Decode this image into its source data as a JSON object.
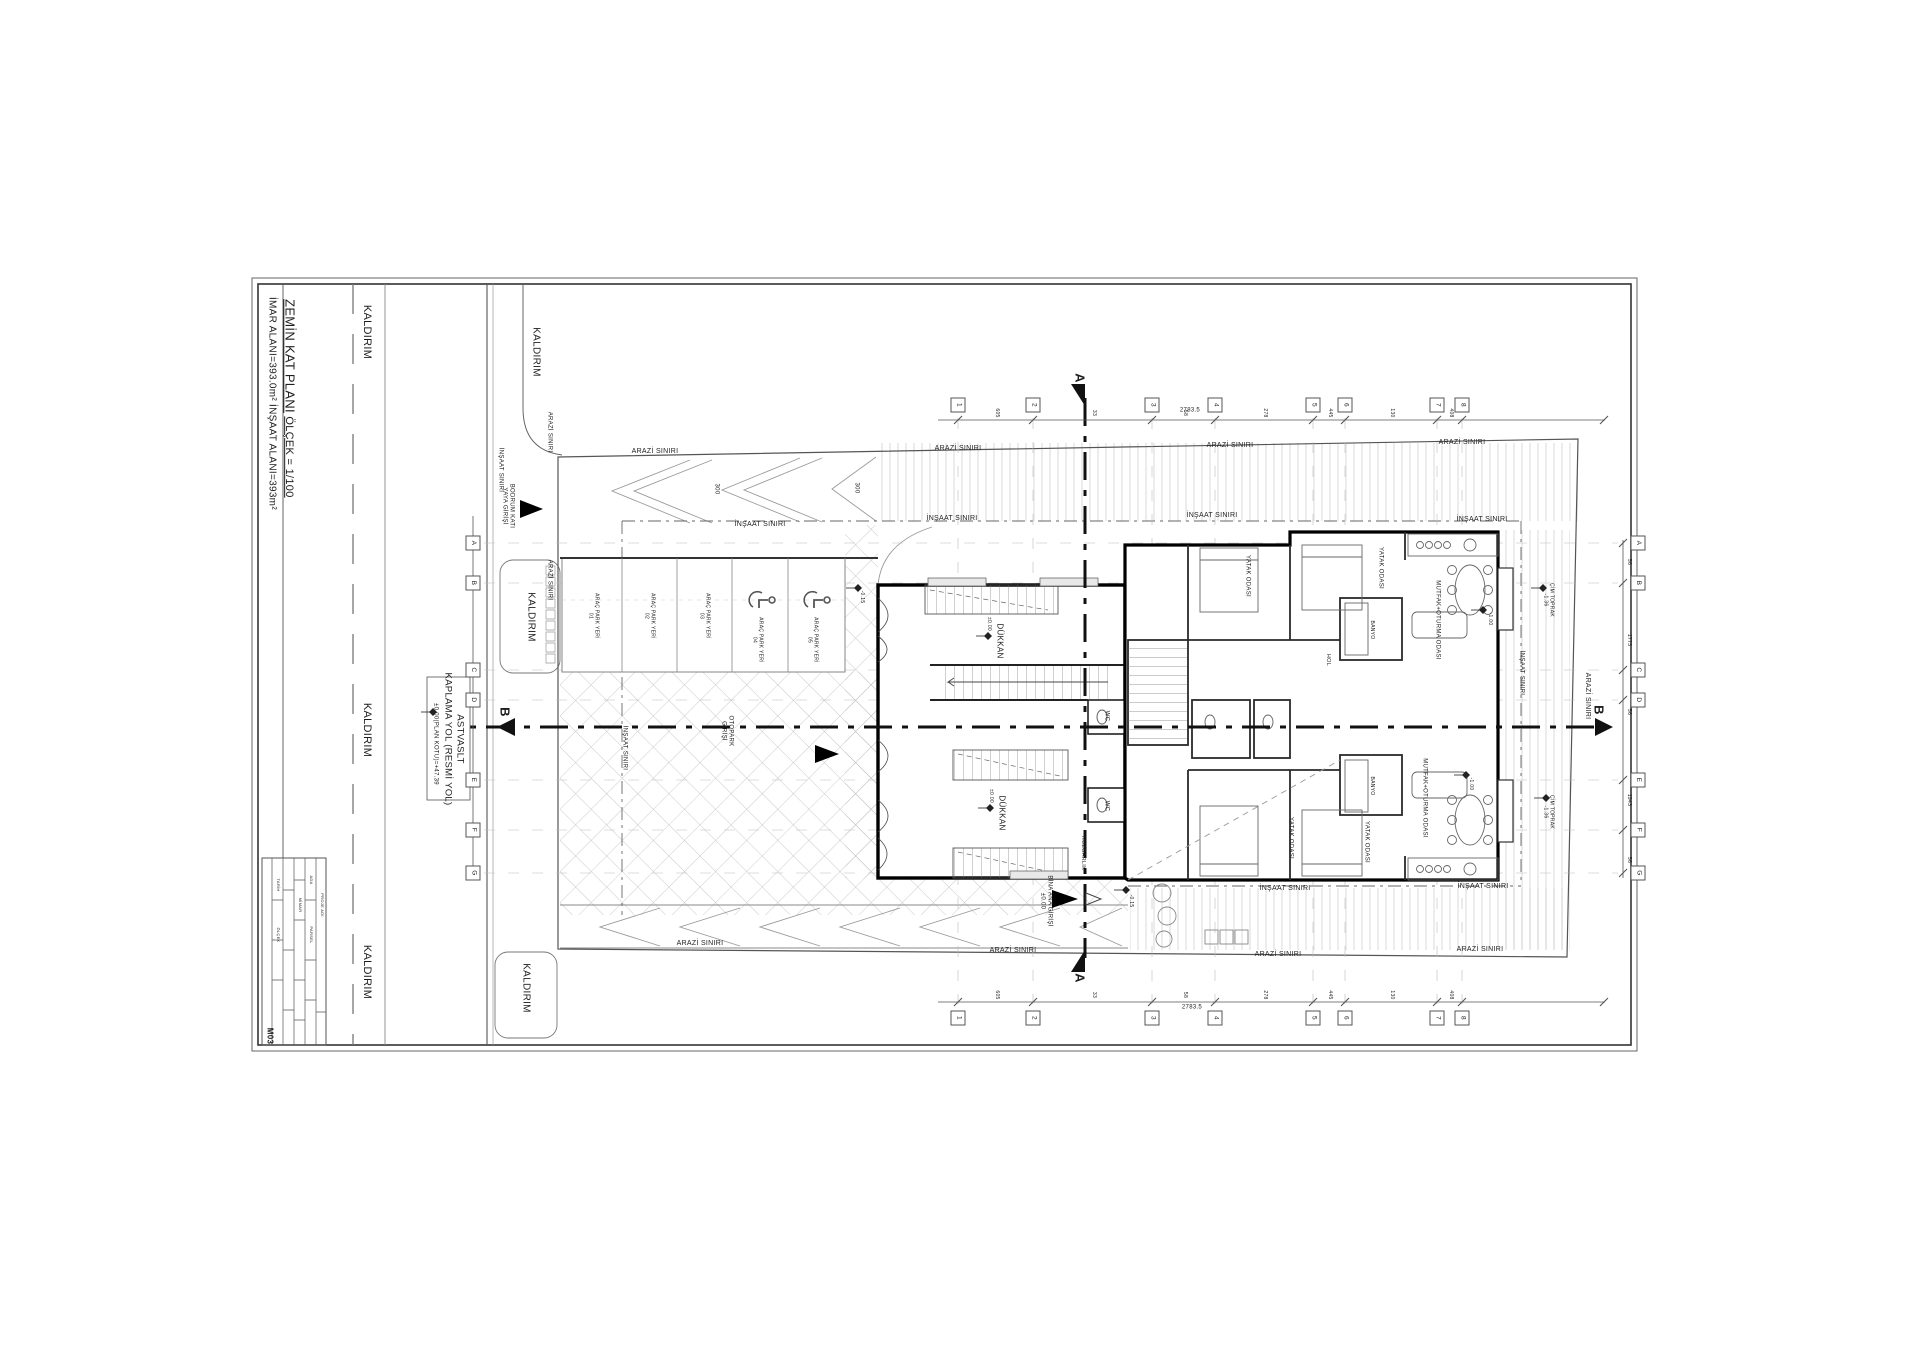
{
  "header": {
    "title": "ZEMİN KAT PLANI",
    "imar": "İMAR ALANI=393.0m²",
    "scale": "ÖLÇEK = 1/100",
    "insaat": "İNŞAAT ALANI=393m²"
  },
  "sheet": {
    "number": "M03"
  },
  "asfalt_box": {
    "line1": "ASTVASLT",
    "line2": "KAPLAMA YOL (RESMİ YOL)",
    "line3": "±0.00(PLAN KOTU)=+47.39"
  },
  "grid": {
    "number_rows": {
      "top": 405,
      "bottom": 1018
    },
    "letter_cols": {
      "left": 473,
      "right": 1638
    },
    "numbers": [
      {
        "label": "1",
        "x": 958
      },
      {
        "label": "2",
        "x": 1033
      },
      {
        "label": "3",
        "x": 1152
      },
      {
        "label": "4",
        "x": 1215
      },
      {
        "label": "5",
        "x": 1313
      },
      {
        "label": "6",
        "x": 1345
      },
      {
        "label": "7",
        "x": 1437
      },
      {
        "label": "8",
        "x": 1462
      }
    ],
    "letters": [
      {
        "label": "A",
        "y": 543
      },
      {
        "label": "B",
        "y": 583
      },
      {
        "label": "C",
        "y": 670
      },
      {
        "label": "D",
        "y": 700
      },
      {
        "label": "E",
        "y": 780
      },
      {
        "label": "F",
        "y": 830
      },
      {
        "label": "G",
        "y": 873
      }
    ]
  },
  "dims": {
    "top_y": 413,
    "bottom_y": 995,
    "right_x": 1628,
    "top": [
      {
        "t": "605",
        "x": 996
      },
      {
        "t": "33",
        "x": 1093
      },
      {
        "t": "58",
        "x": 1184
      },
      {
        "t": "278",
        "x": 1264
      },
      {
        "t": "445",
        "x": 1329
      },
      {
        "t": "130",
        "x": 1391
      },
      {
        "t": "408",
        "x": 1450
      }
    ],
    "bottom": [
      {
        "t": "605",
        "x": 996
      },
      {
        "t": "33",
        "x": 1093
      },
      {
        "t": "58",
        "x": 1184
      },
      {
        "t": "278",
        "x": 1264
      },
      {
        "t": "445",
        "x": 1329
      },
      {
        "t": "130",
        "x": 1391
      },
      {
        "t": "408",
        "x": 1450
      }
    ],
    "right": [
      {
        "t": "56",
        "y": 562
      },
      {
        "t": "1773",
        "y": 640
      },
      {
        "t": "56",
        "y": 712
      },
      {
        "t": "1943",
        "y": 800
      },
      {
        "t": "56",
        "y": 860
      }
    ],
    "total_top": "2783.5",
    "total_bottom": "2783.5"
  },
  "plan": {
    "labels": [
      {
        "t": "KALDIRIM",
        "x": 367,
        "y": 332,
        "s": 11,
        "n": "kaldirim-label"
      },
      {
        "t": "KALDIRIM",
        "x": 367,
        "y": 730,
        "s": 11,
        "n": "kaldirim-label"
      },
      {
        "t": "KALDIRIM",
        "x": 367,
        "y": 972,
        "s": 11,
        "n": "kaldirim-label"
      },
      {
        "t": "KALDIRIM",
        "x": 536,
        "y": 352,
        "s": 10,
        "n": "kaldirim-label"
      },
      {
        "t": "KALDIRIM",
        "x": 531,
        "y": 617,
        "s": 10,
        "n": "kaldirim-label"
      },
      {
        "t": "KALDIRIM",
        "x": 526,
        "y": 988,
        "s": 10,
        "n": "kaldirim-label"
      },
      {
        "t": "ARAZİ SINIRI",
        "x": 655,
        "y": 452,
        "s": 7,
        "r": 0,
        "n": "arazi-siniri-label"
      },
      {
        "t": "ARAZİ SINIRI",
        "x": 958,
        "y": 449,
        "s": 7,
        "r": 0,
        "n": "arazi-siniri-label"
      },
      {
        "t": "ARAZİ SINIRI",
        "x": 1230,
        "y": 446,
        "s": 7,
        "r": 0,
        "n": "arazi-siniri-label"
      },
      {
        "t": "ARAZİ SINIRI",
        "x": 1462,
        "y": 443,
        "s": 7,
        "r": 0,
        "n": "arazi-siniri-label"
      },
      {
        "t": "ARAZİ SINIRI",
        "x": 700,
        "y": 944,
        "s": 7,
        "r": 0,
        "n": "arazi-siniri-label"
      },
      {
        "t": "ARAZİ SINIRI",
        "x": 1013,
        "y": 951,
        "s": 7,
        "r": 0,
        "n": "arazi-siniri-label"
      },
      {
        "t": "ARAZİ SINIRI",
        "x": 1278,
        "y": 955,
        "s": 7,
        "r": 0,
        "n": "arazi-siniri-label"
      },
      {
        "t": "ARAZİ SINIRI",
        "x": 1480,
        "y": 950,
        "s": 7,
        "r": 0,
        "n": "arazi-siniri-label"
      },
      {
        "t": "ARAZİ SINIRI",
        "x": 549,
        "y": 432,
        "s": 6,
        "n": "arazi-siniri-label"
      },
      {
        "t": "ARAZİ SINIRI",
        "x": 549,
        "y": 580,
        "s": 6,
        "n": "arazi-siniri-label"
      },
      {
        "t": "ARAZİ SINIRI",
        "x": 1587,
        "y": 696,
        "s": 7,
        "n": "arazi-siniri-label"
      },
      {
        "t": "İNŞAAT SINIRI",
        "x": 952,
        "y": 519,
        "s": 7,
        "r": 0,
        "n": "insaat-siniri-label"
      },
      {
        "t": "İNŞAAT SINIRI",
        "x": 1212,
        "y": 516,
        "s": 7,
        "r": 0,
        "n": "insaat-siniri-label"
      },
      {
        "t": "İNŞAAT SINIRI",
        "x": 1482,
        "y": 520,
        "s": 7,
        "r": 0,
        "n": "insaat-siniri-label"
      },
      {
        "t": "İNŞAAT SINIRI",
        "x": 760,
        "y": 525,
        "s": 7,
        "r": 0,
        "n": "insaat-siniri-label"
      },
      {
        "t": "İNŞAAT SINIRI",
        "x": 1285,
        "y": 889,
        "s": 7,
        "r": 0,
        "n": "insaat-siniri-label"
      },
      {
        "t": "İNŞAAT SINIRI",
        "x": 1483,
        "y": 887,
        "s": 7,
        "r": 0,
        "n": "insaat-siniri-label"
      },
      {
        "t": "İNŞAAT SINIRI",
        "x": 624,
        "y": 748,
        "s": 6,
        "n": "insaat-siniri-label"
      },
      {
        "t": "İNŞAAT SINIRI",
        "x": 1521,
        "y": 673,
        "s": 6,
        "n": "insaat-siniri-label"
      },
      {
        "t": "İNŞAAT SINIRI",
        "x": 500,
        "y": 470,
        "s": 6,
        "n": "insaat-siniri-label"
      },
      {
        "t": "ARAÇ PARK YERİ\n01",
        "x": 593,
        "y": 616,
        "s": 5,
        "n": "parking-stall-label"
      },
      {
        "t": "ARAÇ PARK YERİ\n02",
        "x": 649,
        "y": 616,
        "s": 5,
        "n": "parking-stall-label"
      },
      {
        "t": "ARAÇ PARK YERİ\n03",
        "x": 704,
        "y": 616,
        "s": 5,
        "n": "parking-stall-label"
      },
      {
        "t": "ARAÇ PARK YERİ\n04",
        "x": 757,
        "y": 640,
        "s": 5,
        "n": "parking-stall-label"
      },
      {
        "t": "ARAÇ PARK YERİ\n05",
        "x": 812,
        "y": 640,
        "s": 5,
        "n": "parking-stall-label"
      },
      {
        "t": "300",
        "x": 716,
        "y": 489,
        "s": 6,
        "n": "dimension-text"
      },
      {
        "t": "300",
        "x": 856,
        "y": 488,
        "s": 6,
        "n": "dimension-text"
      },
      {
        "t": "BODRUM KATI\nYAYA GİRİŞİ",
        "x": 508,
        "y": 506,
        "s": 6,
        "n": "entrance-label"
      },
      {
        "t": "OTOPARK\nGİRİŞİ",
        "x": 727,
        "y": 731,
        "s": 6,
        "n": "entrance-label"
      },
      {
        "t": "BİNA ANA GİRİŞİ\n±0.00",
        "x": 1046,
        "y": 901,
        "s": 6,
        "n": "entrance-label"
      },
      {
        "t": "RÜZGARLIK",
        "x": 1083,
        "y": 853,
        "s": 5.5,
        "n": "room-label"
      },
      {
        "t": "DÜKKAN",
        "x": 999,
        "y": 641,
        "s": 8,
        "n": "room-label"
      },
      {
        "t": "±0.00",
        "x": 988,
        "y": 624,
        "s": 5,
        "n": "elevation-label"
      },
      {
        "t": "DÜKKAN",
        "x": 1001,
        "y": 813,
        "s": 8,
        "n": "room-label"
      },
      {
        "t": "±0.00",
        "x": 990,
        "y": 796,
        "s": 5,
        "n": "elevation-label"
      },
      {
        "t": "WC",
        "x": 1106,
        "y": 716,
        "s": 6,
        "n": "room-label"
      },
      {
        "t": "WC",
        "x": 1106,
        "y": 806,
        "s": 6,
        "n": "room-label"
      },
      {
        "t": "YATAK ODASI",
        "x": 1247,
        "y": 576,
        "s": 6,
        "n": "room-label"
      },
      {
        "t": "YATAK ODASI",
        "x": 1380,
        "y": 568,
        "s": 6,
        "n": "room-label"
      },
      {
        "t": "YATAK ODASI",
        "x": 1290,
        "y": 838,
        "s": 6,
        "n": "room-label"
      },
      {
        "t": "YATAK ODASI",
        "x": 1366,
        "y": 842,
        "s": 6,
        "n": "room-label"
      },
      {
        "t": "MUTFAK+OTURMA ODASI",
        "x": 1437,
        "y": 620,
        "s": 6,
        "n": "room-label"
      },
      {
        "t": "MUTFAK+OTURMA ODASI",
        "x": 1424,
        "y": 798,
        "s": 6,
        "n": "room-label"
      },
      {
        "t": "HOL",
        "x": 1328,
        "y": 660,
        "s": 5.5,
        "n": "room-label"
      },
      {
        "t": "BANYO",
        "x": 1371,
        "y": 630,
        "s": 5,
        "n": "room-label"
      },
      {
        "t": "BANYO",
        "x": 1371,
        "y": 786,
        "s": 5,
        "n": "room-label"
      },
      {
        "t": "-1.00",
        "x": 1489,
        "y": 619,
        "s": 5,
        "n": "elevation-label"
      },
      {
        "t": "-1.00",
        "x": 1470,
        "y": 784,
        "s": 5,
        "n": "elevation-label"
      },
      {
        "t": "ÇİM TOPRAK\n-1.36",
        "x": 1548,
        "y": 600,
        "s": 5,
        "n": "elevation-label"
      },
      {
        "t": "ÇİM TOPRAK\n-1.36",
        "x": 1548,
        "y": 812,
        "s": 5,
        "n": "elevation-label"
      },
      {
        "t": "-0.15",
        "x": 861,
        "y": 597,
        "s": 5,
        "n": "elevation-label"
      },
      {
        "t": "-0.15",
        "x": 1130,
        "y": 901,
        "s": 5,
        "n": "elevation-label"
      },
      {
        "t": "A",
        "x": 1079,
        "y": 378,
        "s": 13,
        "b": 1,
        "n": "section-letter-a"
      },
      {
        "t": "A",
        "x": 1079,
        "y": 978,
        "s": 13,
        "b": 1,
        "n": "section-letter-a"
      },
      {
        "t": "B",
        "x": 504,
        "y": 712,
        "s": 13,
        "b": 1,
        "n": "section-letter-b"
      },
      {
        "t": "B",
        "x": 1598,
        "y": 710,
        "s": 13,
        "b": 1,
        "n": "section-letter-b"
      },
      {
        "t": "2783.5",
        "x": 1190,
        "y": 411,
        "s": 6,
        "r": 0,
        "n": "dimension-total"
      },
      {
        "t": "2783.5",
        "x": 1192,
        "y": 1008,
        "s": 6,
        "r": 0,
        "n": "dimension-total"
      },
      {
        "t": "PROJE ADI",
        "x": 322,
        "y": 905,
        "s": 4,
        "n": "title-table-text"
      },
      {
        "t": "ADA",
        "x": 311,
        "y": 880,
        "s": 4,
        "n": "title-table-text"
      },
      {
        "t": "PARSEL",
        "x": 311,
        "y": 935,
        "s": 4,
        "n": "title-table-text"
      },
      {
        "t": "MİMAR",
        "x": 300,
        "y": 905,
        "s": 4,
        "n": "title-table-text"
      },
      {
        "t": "TARİH",
        "x": 278,
        "y": 885,
        "s": 4,
        "n": "title-table-text"
      },
      {
        "t": "ÖLÇEK",
        "x": 278,
        "y": 935,
        "s": 4,
        "n": "title-table-text"
      }
    ]
  }
}
